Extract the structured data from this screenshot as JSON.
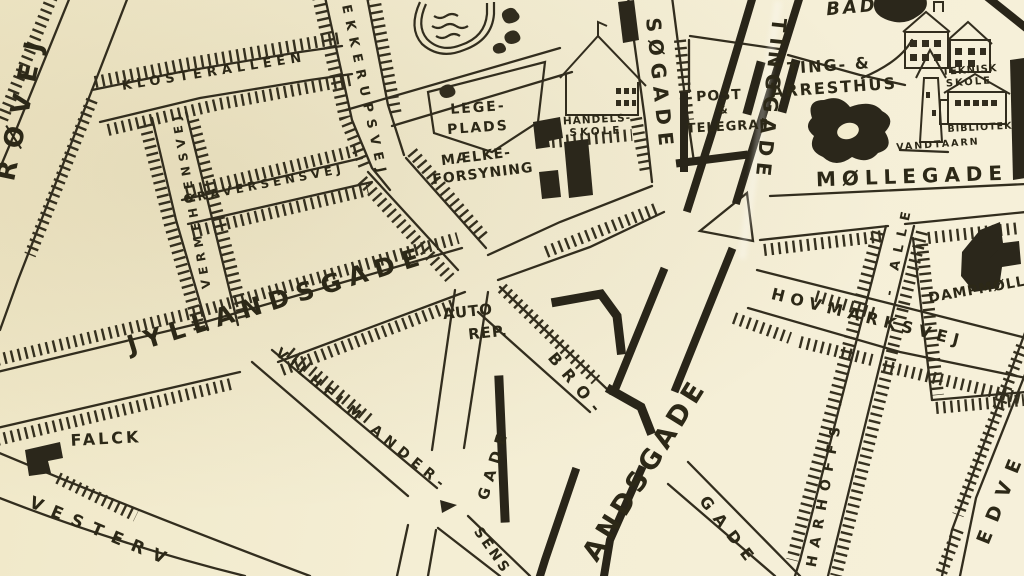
{
  "map": {
    "colors": {
      "paper": "#f3ecce",
      "ink": "#312d22"
    },
    "streets": {
      "rovej": "RØVEJ",
      "klosteralleen": "KLOSTERALLÉEN",
      "ekkerupsvej": "EKKERUPSVEJ",
      "vermehrensvej": "VERMEHRENSVEJ",
      "graversensvej": "GRAVERSENSVEJ",
      "jyllandsgade": "JYLLANDSGADE",
      "vilhelm_ander": "VILHELM ANDER-",
      "va_gade": "GADE",
      "sens": "SENS",
      "bro": "BRO-",
      "bro_gade": "GADE",
      "andsgade": "ANDSGADE",
      "tinggade": "TINGGADE",
      "sogade": "SØGADE",
      "mollegade": "MØLLEGADE",
      "hovmarksvej": "HOVMARKSVEJ",
      "harhoffs": "HARHOFFS -",
      "harhoffs_alle": "- ALLE",
      "edvej": "EDVE",
      "vestervej": "VESTERV"
    },
    "places": {
      "falck": "FALCK",
      "lege": "LEGE-",
      "plads": "PLADS",
      "handels": "HANDELS-",
      "handels_skole": "SKOLE",
      "maelke": "MÆLKE-",
      "forsyning": "FORSYNING",
      "post": "POST",
      "post_amp": "&",
      "telegraf": "TELEGRAF",
      "ting_arrest_1": "TING- &",
      "ting_arrest_2": "ARRESTHUS",
      "teknisk": "TEKNISK",
      "teknisk_skole": "SKOLE",
      "vandtaarn": "VANDTAARN",
      "bibliotek": "BIBLIOTEK",
      "bad": "BAD",
      "dampmolle": "DAMPMØLL",
      "auto": "AUTO",
      "rep": "REP."
    }
  }
}
